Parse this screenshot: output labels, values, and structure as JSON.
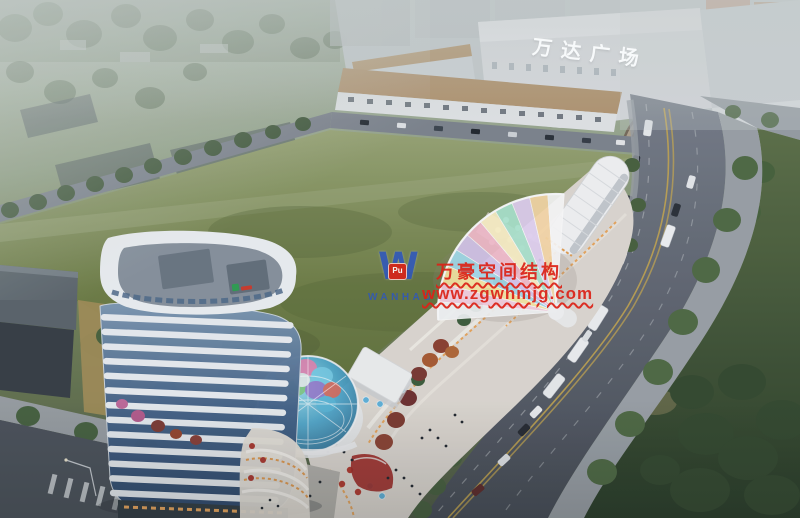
{
  "texts": {
    "mall_sign": "万达广场",
    "watermark_brand": "万豪空间结构",
    "watermark_url": "www.zgwhmjg.com",
    "watermark_logo_letter": "W",
    "watermark_logo_badge": "Pu",
    "watermark_logo_name": "WANHAO"
  },
  "colors": {
    "watermark_red": "#dc2318",
    "watermark_blue": "#2b55c6",
    "badge_red": "#d6251a",
    "field_green": "#6e7e46",
    "road_grey": "#4a505a",
    "tower_white": "#e9eef2",
    "tower_glass": "#45648a",
    "dome_teal": "#4fa8cc",
    "canopy_pink": "#f7d0e2",
    "canopy_yellow": "#f9e9a4",
    "canopy_cyan": "#a4ddef",
    "warm_light": "#e8a050"
  }
}
